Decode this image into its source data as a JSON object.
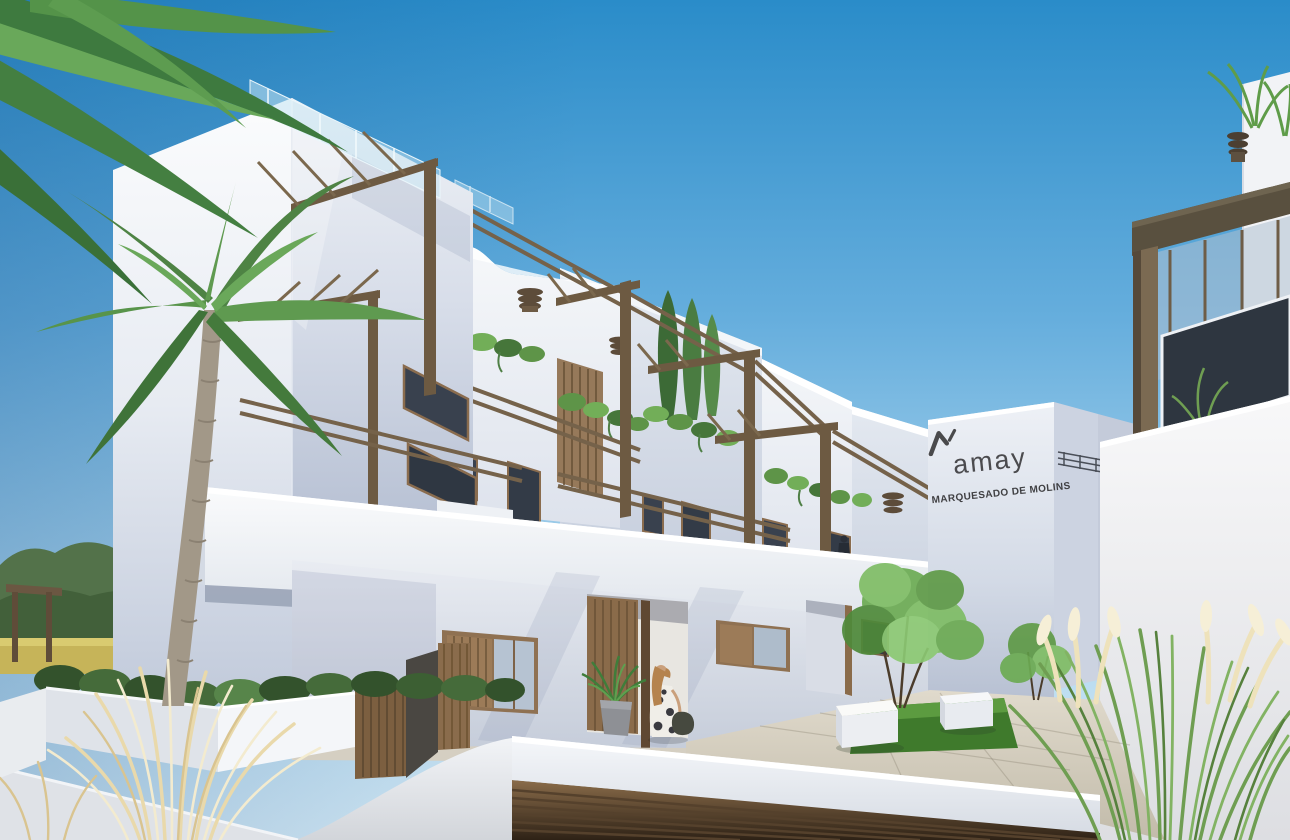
{
  "scene": {
    "description": "3D architectural rendering of a white Mediterranean apartment complex with wooden pergola terraces, palm trees, ornamental grasses, a paved courtyard with lawn and cube benches, an underground garage with wooden slat door, and a woman walking to the entrance",
    "signage": {
      "logo_mark": "amay-monogram",
      "logo_text": "amay",
      "building_name": "MARQUESADO DE MOLINS"
    },
    "objects": {
      "person": "woman with handbag at entrance",
      "balcony_person": 1,
      "cube_benches": 2,
      "courtyard_trees": 2,
      "palm_trees": 2,
      "cypress_trees": 3,
      "garage_door": "wooden slats",
      "terrace_pergolas": "dark timber frames"
    },
    "palette": {
      "sky_top": "#2a8cc9",
      "sky_horizon": "#d8ecf7",
      "wall_lit": "#f6f8fa",
      "wall_shade": "#b6bfd2",
      "timber": "#6d5a42",
      "wood_door": "#8a6b4a",
      "foliage": "#5f9a50",
      "lawn": "#4a8a33",
      "pavement": "#d6cfc1",
      "dry_grass": "#ead9a8",
      "sign_text": "#47474a"
    }
  }
}
